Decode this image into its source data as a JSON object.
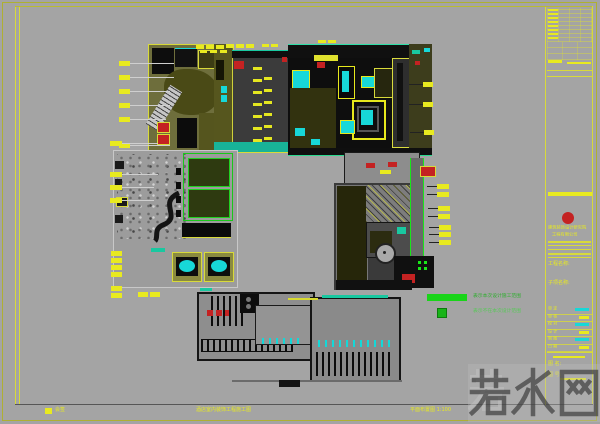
{
  "meta": {
    "type": "cad-floor-plan-sheet"
  },
  "palette": {
    "sheet_bg": "#a4a4a4",
    "frame_olive": "#aeb032",
    "frame_yellow": "#d8da3a",
    "plan_black": "#0d0d0d",
    "hall_dark": "#3b3b3b",
    "annotation_yellow": "#e8ea20",
    "fixture_cyan": "#17d8d8",
    "corridor_teal": "#19c8a0",
    "legend_green": "#19d419",
    "stamp_red": "#c42222",
    "leader_gray": "#cfcfcf",
    "watermark_gray": "#3a3a3a"
  },
  "watermark": {
    "text": "若水网"
  },
  "legend": {
    "row1": "表示本次设计施工范围",
    "row2": "表示不在本次设计范围"
  },
  "bottom_bar": {
    "left": "会签",
    "mid": "酒店室内装饰工程施工图",
    "right": "平面布置图 1:100"
  },
  "titleblock": {
    "company1": "建筑装饰设计研究院",
    "company2": "工程有限公司",
    "field1": "工程名称:",
    "field2": "子项名称:",
    "rows": [
      {
        "label": "审 定",
        "cyan": true
      },
      {
        "label": "审 核",
        "cyan": false
      },
      {
        "label": "校 对",
        "cyan": true
      },
      {
        "label": "设 计",
        "cyan": false
      },
      {
        "label": "制 图",
        "cyan": true
      },
      {
        "label": "日 期",
        "cyan": false
      }
    ],
    "sheet_label": "图 名:",
    "sheet_no": "图 号:"
  },
  "annotations": {
    "markers": [
      {
        "x": 119,
        "y": 61,
        "w": 11,
        "h": 5,
        "l": 44,
        "ld": "r"
      },
      {
        "x": 119,
        "y": 75,
        "w": 11,
        "h": 5,
        "l": 44,
        "ld": "r"
      },
      {
        "x": 119,
        "y": 89,
        "w": 11,
        "h": 5,
        "l": 40,
        "ld": "r"
      },
      {
        "x": 119,
        "y": 103,
        "w": 11,
        "h": 5,
        "l": 40,
        "ld": "r"
      },
      {
        "x": 119,
        "y": 117,
        "w": 11,
        "h": 5,
        "l": 36,
        "ld": "r"
      },
      {
        "x": 119,
        "y": 143,
        "w": 11,
        "h": 5,
        "l": 40,
        "ld": "r"
      },
      {
        "x": 196,
        "y": 45,
        "w": 8,
        "h": 4
      },
      {
        "x": 206,
        "y": 45,
        "w": 8,
        "h": 4
      },
      {
        "x": 216,
        "y": 45,
        "w": 8,
        "h": 4
      },
      {
        "x": 226,
        "y": 44,
        "w": 8,
        "h": 4
      },
      {
        "x": 236,
        "y": 44,
        "w": 8,
        "h": 4
      },
      {
        "x": 246,
        "y": 44,
        "w": 8,
        "h": 4
      },
      {
        "x": 200,
        "y": 50,
        "w": 7,
        "h": 3
      },
      {
        "x": 210,
        "y": 50,
        "w": 7,
        "h": 3
      },
      {
        "x": 220,
        "y": 50,
        "w": 7,
        "h": 3
      },
      {
        "x": 262,
        "y": 44,
        "w": 7,
        "h": 3
      },
      {
        "x": 271,
        "y": 44,
        "w": 7,
        "h": 3
      },
      {
        "x": 318,
        "y": 40,
        "w": 8,
        "h": 3
      },
      {
        "x": 328,
        "y": 40,
        "w": 8,
        "h": 3
      },
      {
        "x": 110,
        "y": 141,
        "w": 12,
        "h": 5,
        "l": 36,
        "ld": "r"
      },
      {
        "x": 110,
        "y": 172,
        "w": 12,
        "h": 5,
        "l": 36,
        "ld": "r"
      },
      {
        "x": 110,
        "y": 185,
        "w": 12,
        "h": 5,
        "l": 32,
        "ld": "r"
      },
      {
        "x": 110,
        "y": 198,
        "w": 12,
        "h": 5,
        "l": 32,
        "ld": "r"
      },
      {
        "x": 111,
        "y": 251,
        "w": 11,
        "h": 5
      },
      {
        "x": 111,
        "y": 258,
        "w": 11,
        "h": 5
      },
      {
        "x": 111,
        "y": 265,
        "w": 11,
        "h": 5
      },
      {
        "x": 111,
        "y": 272,
        "w": 11,
        "h": 5
      },
      {
        "x": 111,
        "y": 286,
        "w": 11,
        "h": 5
      },
      {
        "x": 111,
        "y": 293,
        "w": 11,
        "h": 5
      },
      {
        "x": 138,
        "y": 292,
        "w": 10,
        "h": 5
      },
      {
        "x": 150,
        "y": 292,
        "w": 10,
        "h": 5
      },
      {
        "x": 423,
        "y": 82,
        "w": 10,
        "h": 5,
        "l": 14,
        "ld": "l"
      },
      {
        "x": 423,
        "y": 102,
        "w": 10,
        "h": 5,
        "l": 14,
        "ld": "l"
      },
      {
        "x": 424,
        "y": 130,
        "w": 10,
        "h": 5,
        "l": 14,
        "ld": "l"
      },
      {
        "x": 437,
        "y": 184,
        "w": 12,
        "h": 5,
        "l": 10,
        "ld": "l"
      },
      {
        "x": 437,
        "y": 192,
        "w": 12,
        "h": 5,
        "l": 10,
        "ld": "l"
      },
      {
        "x": 438,
        "y": 206,
        "w": 12,
        "h": 5,
        "l": 10,
        "ld": "l"
      },
      {
        "x": 438,
        "y": 214,
        "w": 12,
        "h": 5,
        "l": 10,
        "ld": "l"
      },
      {
        "x": 439,
        "y": 225,
        "w": 12,
        "h": 5,
        "l": 10,
        "ld": "l"
      },
      {
        "x": 439,
        "y": 232,
        "w": 12,
        "h": 5,
        "l": 10,
        "ld": "l"
      },
      {
        "x": 439,
        "y": 240,
        "w": 12,
        "h": 5,
        "l": 10,
        "ld": "l"
      }
    ]
  }
}
